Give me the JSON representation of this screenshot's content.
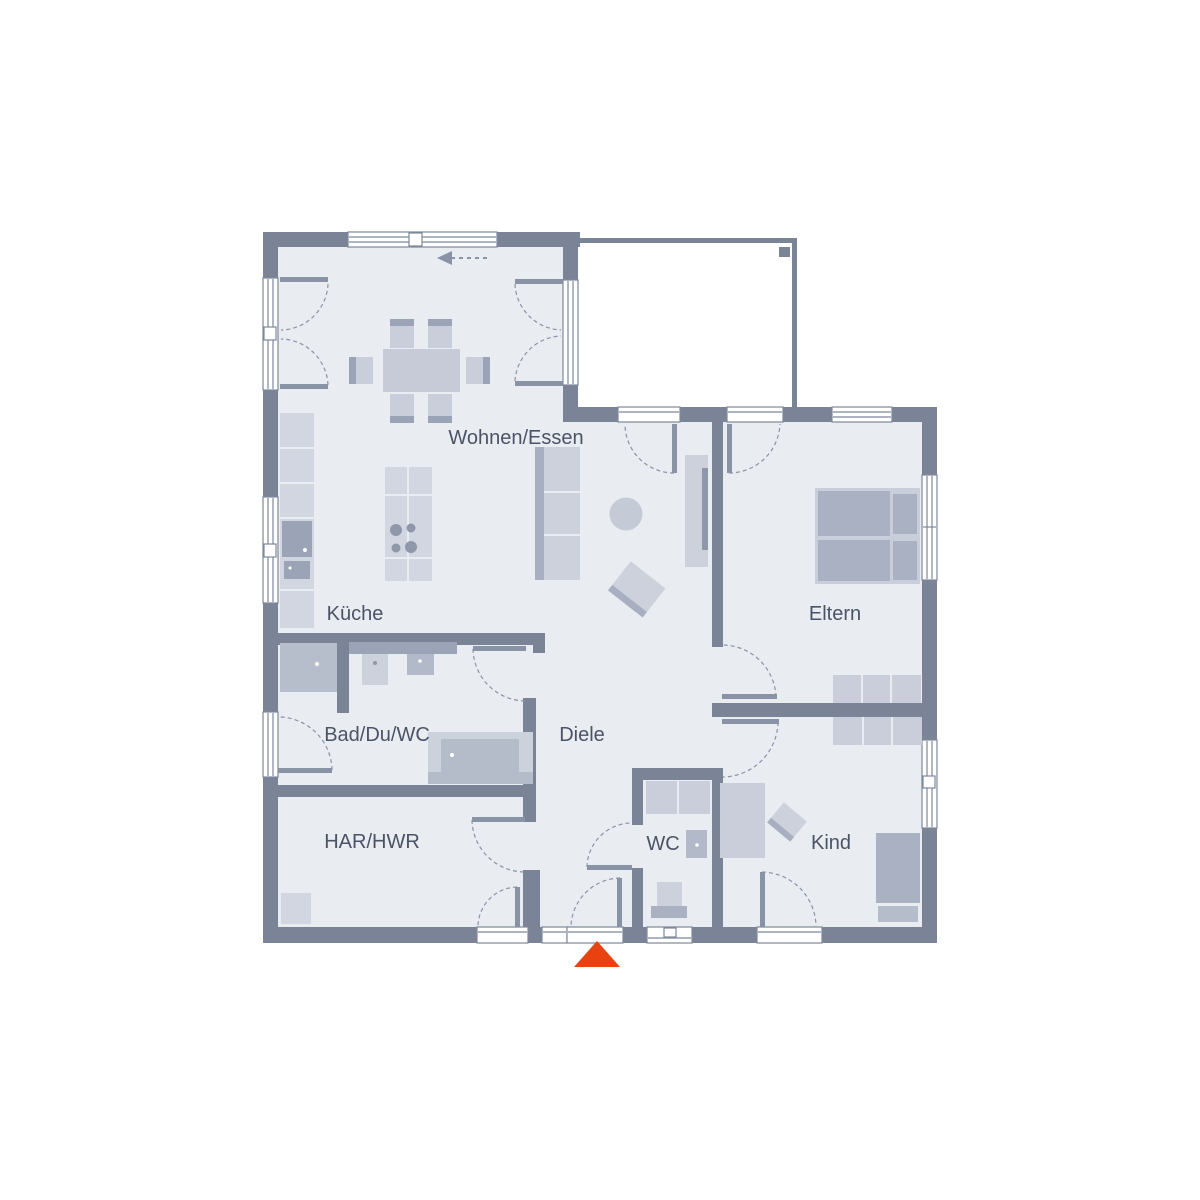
{
  "palette": {
    "wall": "#7b8497",
    "floor": "#e9ecf1",
    "furniture_light": "#d2d6e0",
    "furniture_mid": "#c6cbd7",
    "furniture_dark": "#a9b1c2",
    "furniture_deep": "#8f98ab",
    "glazing_frame": "#7e889b",
    "door_line": "#8a93a6",
    "label_text": "#4b5466",
    "accent_red": "#e8420f",
    "white": "#ffffff"
  },
  "plan": {
    "rooms": [
      {
        "id": "wohnen_essen",
        "label": "Wohnen/Essen"
      },
      {
        "id": "kueche",
        "label": "Küche"
      },
      {
        "id": "eltern",
        "label": "Eltern"
      },
      {
        "id": "bad_du_wc",
        "label": "Bad/Du/WC"
      },
      {
        "id": "diele",
        "label": "Diele"
      },
      {
        "id": "har_hwr",
        "label": "HAR/HWR"
      },
      {
        "id": "wc",
        "label": "WC"
      },
      {
        "id": "kind",
        "label": "Kind"
      }
    ],
    "icons": [
      {
        "name": "entrance-marker",
        "shape": "triangle-up",
        "color": "#e8420f"
      },
      {
        "name": "slide-direction-arrow",
        "shape": "dashed-arrow-left",
        "color": "#8a93a6"
      }
    ]
  }
}
